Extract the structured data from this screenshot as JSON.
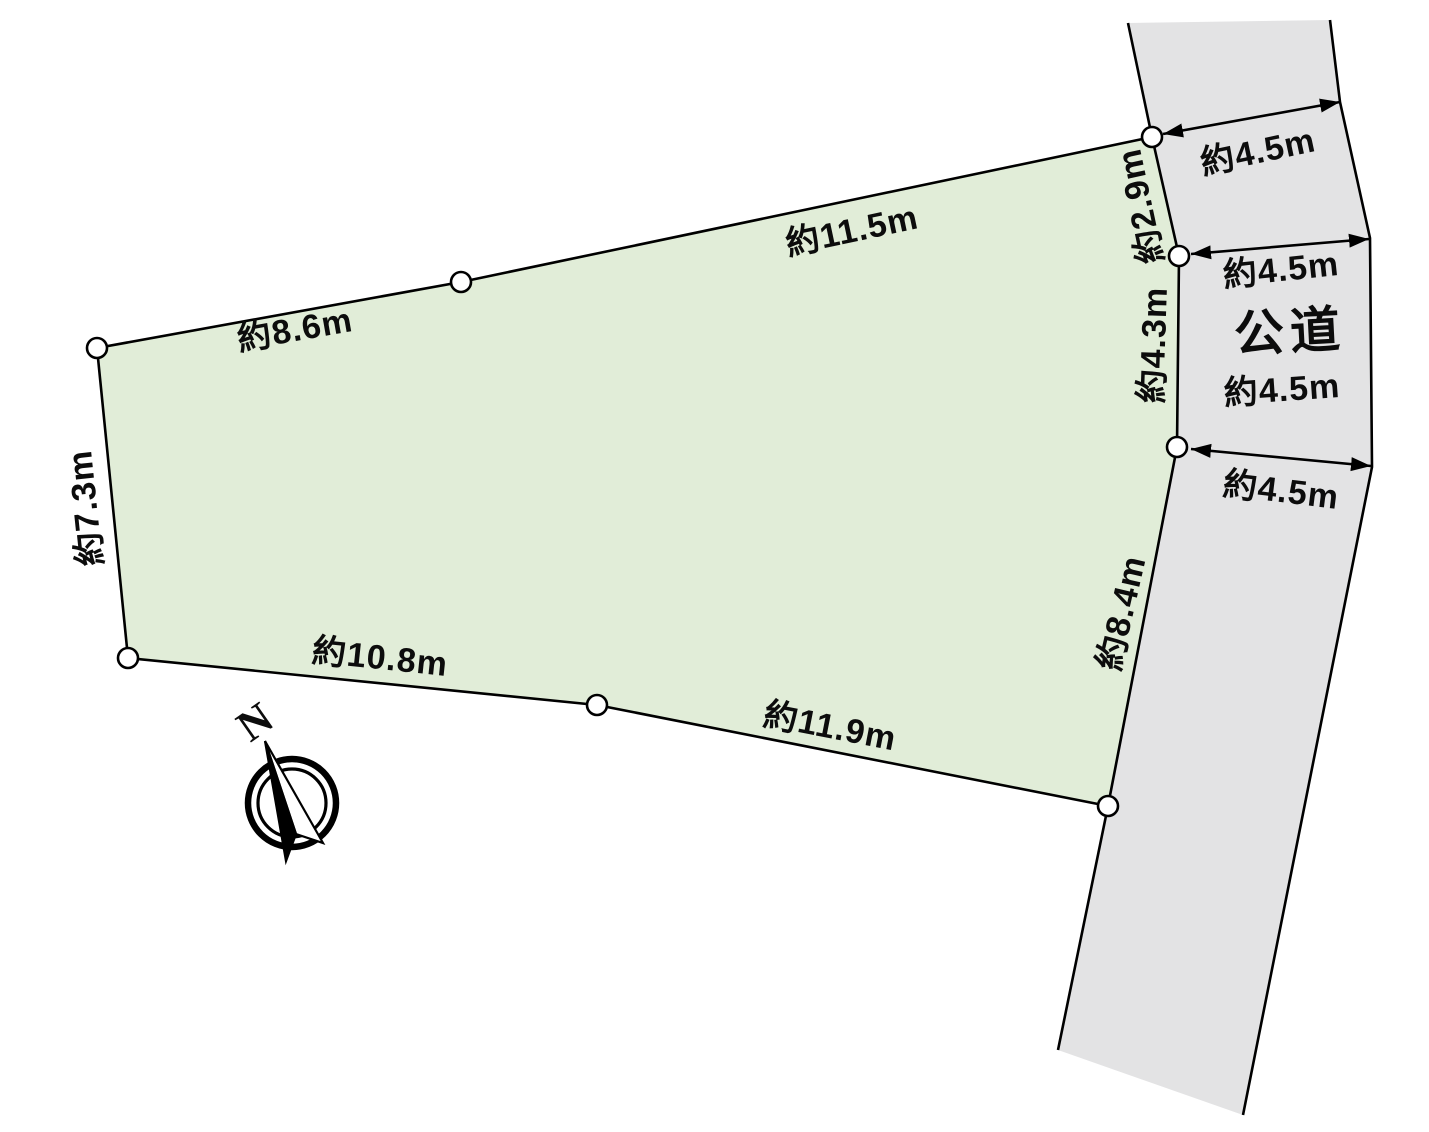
{
  "diagram": {
    "plot": {
      "fill_color": "#e1edd8",
      "edge_labels": {
        "top_left": "約8.6m",
        "top_right": "約11.5m",
        "left": "約7.3m",
        "bottom_left": "約10.8m",
        "bottom_right": "約11.9m",
        "right_upper": "約2.9m",
        "right_middle": "約4.3m",
        "right_lower": "約8.4m"
      }
    },
    "road": {
      "fill_color": "#e3e3e4",
      "name_label": "公道",
      "width_labels": [
        "約4.5m",
        "約4.5m",
        "約4.5m",
        "約4.5m"
      ]
    },
    "compass": {
      "north_label": "N"
    },
    "line_color": "#000000"
  }
}
